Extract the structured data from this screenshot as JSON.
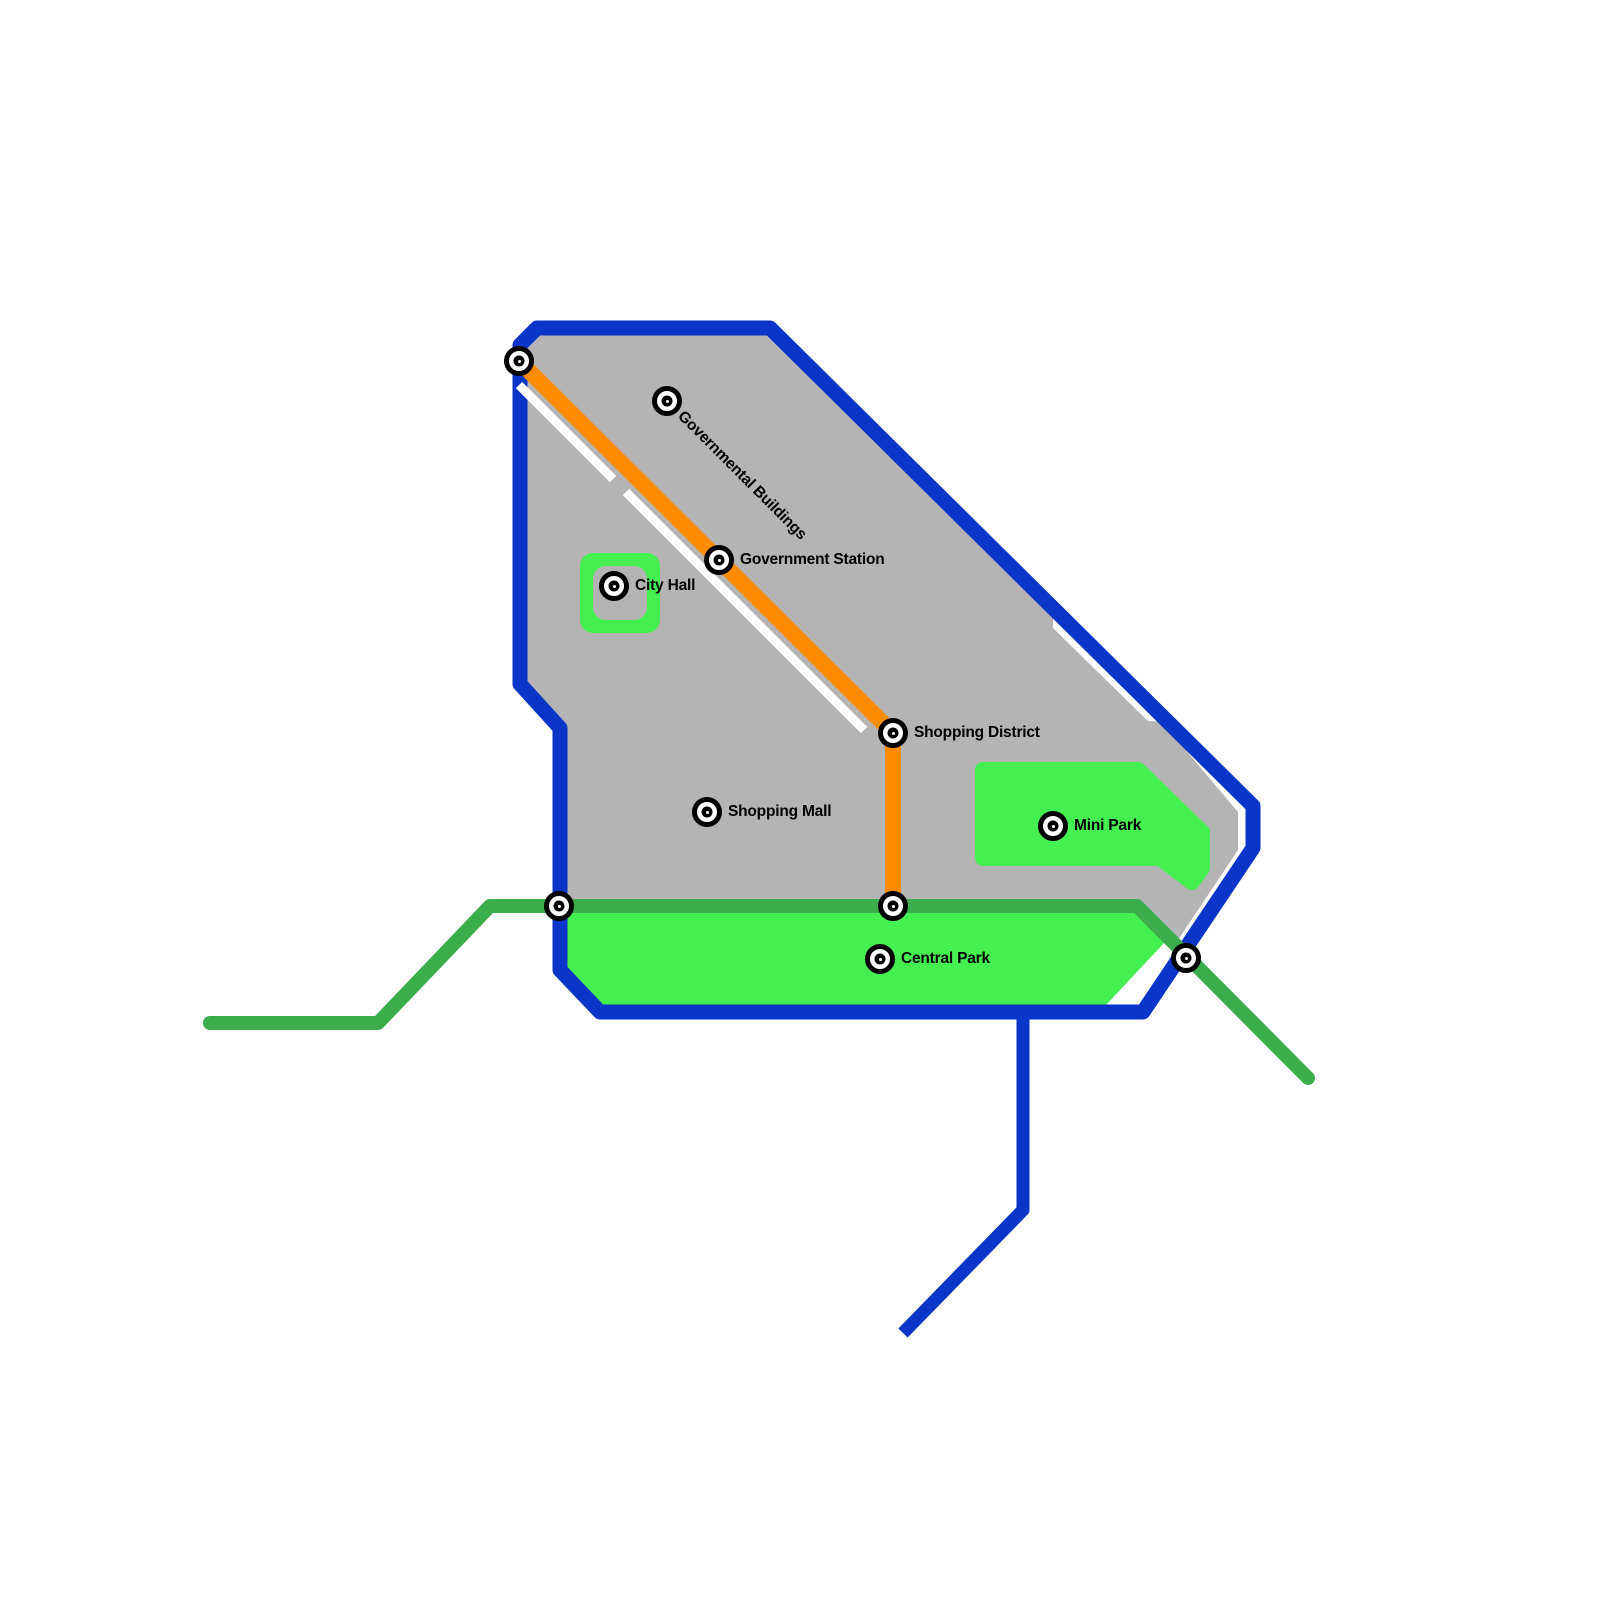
{
  "map": {
    "type": "transit-city-map",
    "colors": {
      "background": "#FFFFFF",
      "border_blue": "#0936C8",
      "line_orange": "#FF8C00",
      "line_green": "#3CAD4D",
      "park_green": "#45EF51",
      "city_gray": "#B4B4B4",
      "station_ring": "#000000",
      "label_text": "#000000"
    },
    "stations": [
      {
        "id": "northwest-terminus",
        "label": "",
        "x": 519,
        "y": 361,
        "rot": 0
      },
      {
        "id": "governmental-buildings",
        "label": "Governmental Buildings",
        "x": 667,
        "y": 401,
        "rot": 45
      },
      {
        "id": "government-station",
        "label": "Government Station",
        "x": 719,
        "y": 560,
        "rot": 0
      },
      {
        "id": "city-hall",
        "label": "City Hall",
        "x": 614,
        "y": 586,
        "rot": 0
      },
      {
        "id": "shopping-district",
        "label": "Shopping District",
        "x": 893,
        "y": 733,
        "rot": 0
      },
      {
        "id": "shopping-mall",
        "label": "Shopping Mall",
        "x": 707,
        "y": 812,
        "rot": 0
      },
      {
        "id": "mini-park",
        "label": "Mini Park",
        "x": 1053,
        "y": 826,
        "rot": 0
      },
      {
        "id": "west-line-crossing",
        "label": "",
        "x": 559,
        "y": 906,
        "rot": 0
      },
      {
        "id": "orange-line-junction",
        "label": "",
        "x": 893,
        "y": 906,
        "rot": 0
      },
      {
        "id": "central-park",
        "label": "Central Park",
        "x": 880,
        "y": 959,
        "rot": 0
      },
      {
        "id": "southeast-crossing",
        "label": "",
        "x": 1186,
        "y": 958,
        "rot": 0
      }
    ]
  }
}
